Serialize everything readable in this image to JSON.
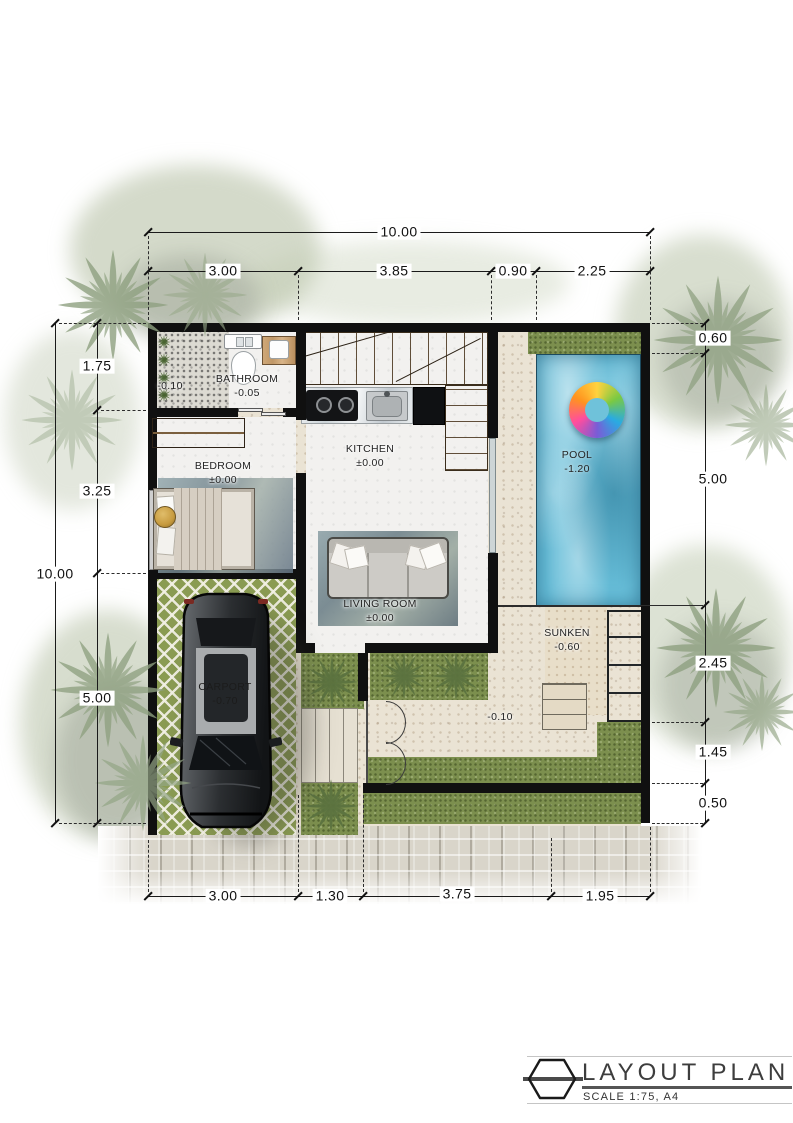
{
  "title_block": {
    "title": "LAYOUT PLAN",
    "scale_note": "SCALE 1:75, A4"
  },
  "rooms": {
    "patio": {
      "level": "-0.10"
    },
    "bathroom": {
      "name": "BATHROOM",
      "level": "-0.05"
    },
    "bedroom": {
      "name": "BEDROOM",
      "level": "±0.00"
    },
    "kitchen": {
      "name": "KITCHEN",
      "level": "±0.00"
    },
    "living_room": {
      "name": "LIVING ROOM",
      "level": "±0.00"
    },
    "carport": {
      "name": "CARPORT",
      "level": "-0.70"
    },
    "pool": {
      "name": "POOL",
      "level": "-1.20"
    },
    "sunken": {
      "name": "SUNKEN",
      "level": "-0.60"
    },
    "terrace": {
      "level": "-0.10"
    }
  },
  "dimensions": {
    "overall_width": "10.00",
    "overall_height": "10.00",
    "top": [
      "3.00",
      "3.85",
      "0.90",
      "2.25"
    ],
    "left": [
      "1.75",
      "3.25",
      "5.00"
    ],
    "right": [
      "0.60",
      "5.00",
      "2.45",
      "1.45",
      "0.50"
    ],
    "bottom": [
      "3.00",
      "1.30",
      "3.75",
      "1.95"
    ]
  },
  "colors": {
    "wall": "#101010",
    "pool_water": "#66bdd8",
    "grass": "#7c8f4e",
    "travertine": "#eae3d4",
    "wood": "#c9a774",
    "swim_ring": [
      "#ffd23f",
      "#7ac943",
      "#29abe2",
      "#7a5cd6",
      "#ff4d9e",
      "#ff931e"
    ]
  }
}
